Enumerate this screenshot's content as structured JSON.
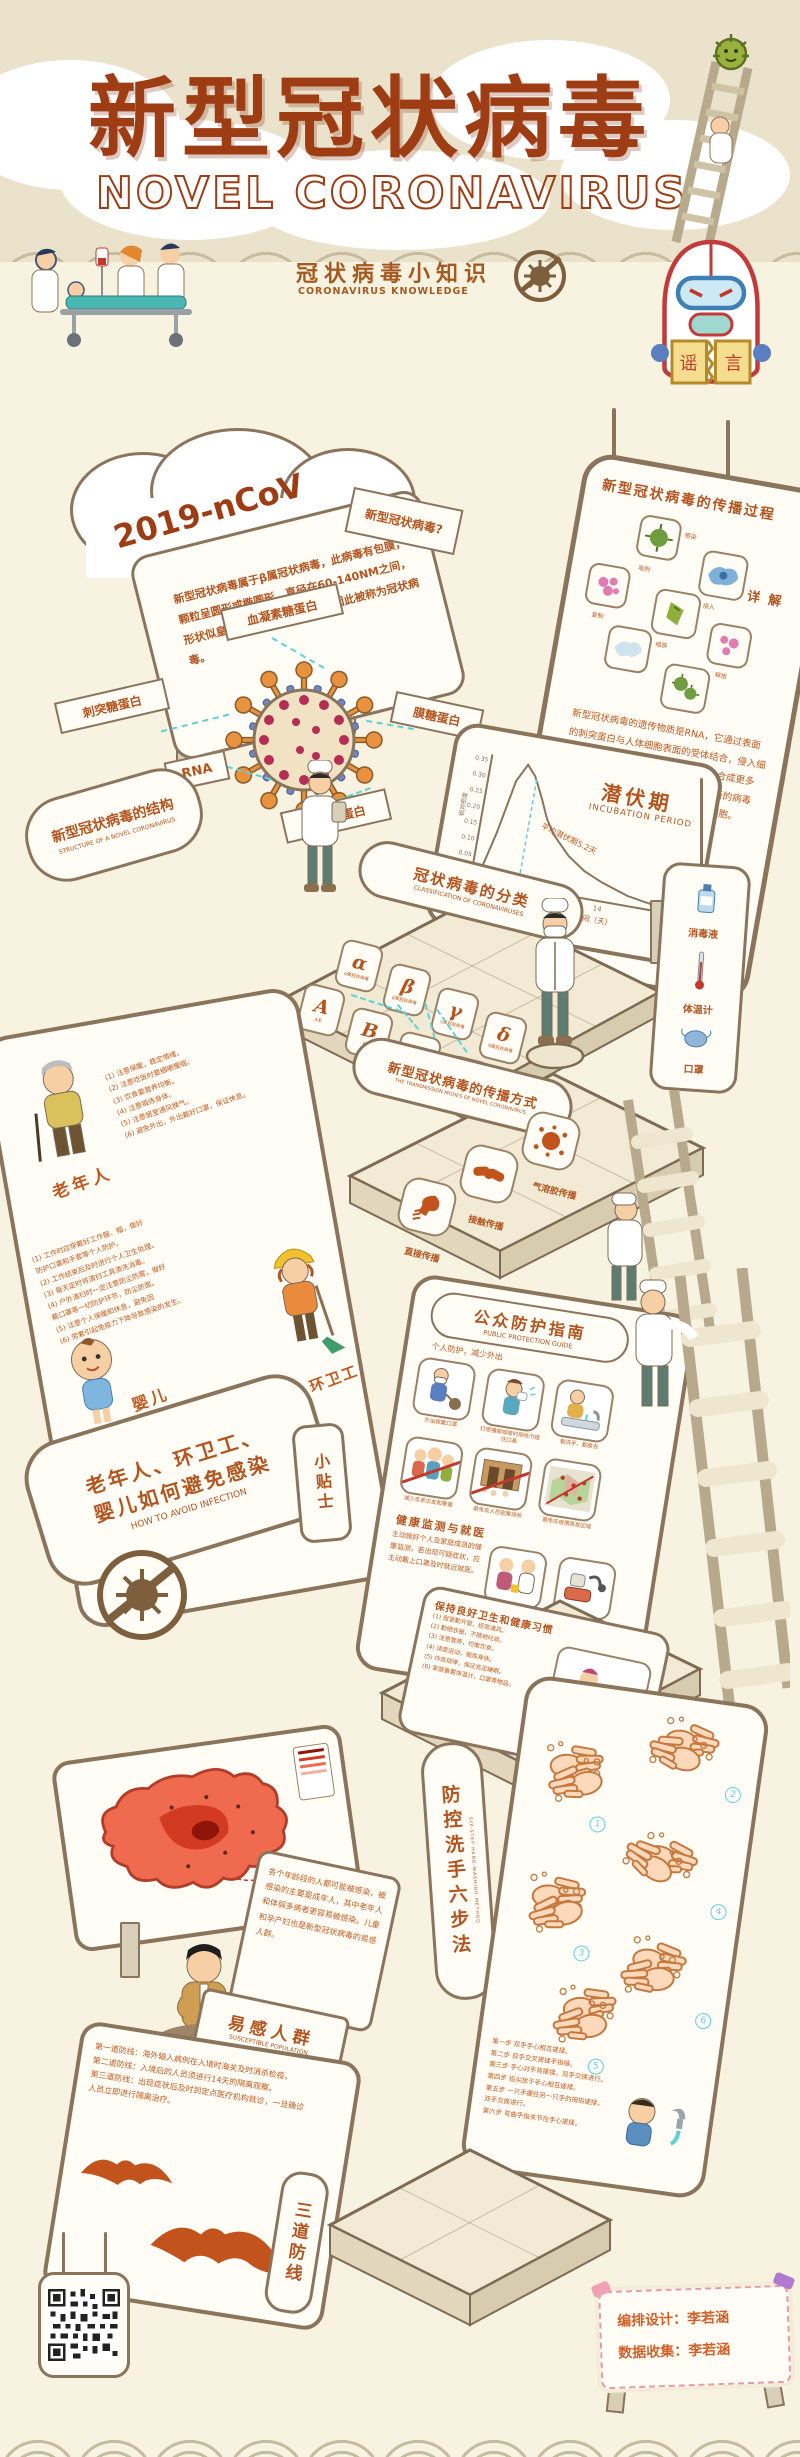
{
  "header": {
    "title": "新型冠状病毒",
    "subtitle": "NOVEL CORONAVIRUS",
    "tagline_zh": "冠状病毒小知识",
    "tagline_en": "CORONAVIRUS KNOWLEDGE",
    "rumor_left": "谣",
    "rumor_right": "言"
  },
  "intro": {
    "cloud_label": "2019-nCoV",
    "board_text": "新型冠状病毒属于β属冠状病毒，此病毒有包膜，颗粒呈圆形或椭圆形，直径在60-140NM之间，形状似皇冠，因表面凸凹不平，因此被称为冠状病毒。",
    "question_sign": "新型冠状病毒?"
  },
  "structure": {
    "sign_zh": "新型冠状病毒的结构",
    "sign_en": "STRUCTURE OF A NOVEL CORONAVIRUS",
    "label_hemagglutinin": "血凝素糖蛋白",
    "label_spike": "刺突糖蛋白",
    "label_rna": "RNA",
    "label_nucleocapsid": "核衣壳蛋白",
    "label_membrane": "膜糖蛋白"
  },
  "spread": {
    "title": "新型冠状病毒的传播过程",
    "detail_title": "详 解",
    "detail_text": "新型冠状病毒的遗传物质是RNA，它通过表面的刺突蛋白与人体细胞表面的受体结合，侵入细胞后释放RNA并进行复制，利用细胞合成更多的病毒蛋白质和RNA片段，再组装成新的病毒颗粒释放出来，继续感染更多的健康细胞。",
    "steps": [
      "感染",
      "吸附",
      "侵入",
      "复制",
      "组装",
      "释放"
    ]
  },
  "incubation": {
    "title_zh": "潜伏期",
    "title_en": "INCUBATION PERIOD",
    "annotation": "平均潜伏期5.2天",
    "xlabel": "从感染到发病的时间（天）",
    "ylabel": "相对密度"
  },
  "chart_data": {
    "type": "area",
    "title": "潜伏期 INCUBATION PERIOD",
    "xlabel": "从感染到发病的时间（天）",
    "ylabel": "相对密度",
    "x": [
      0,
      1,
      2,
      3,
      4,
      5,
      6,
      7,
      8,
      10,
      12,
      14,
      17,
      21
    ],
    "y": [
      0,
      0.04,
      0.15,
      0.28,
      0.34,
      0.31,
      0.25,
      0.19,
      0.15,
      0.09,
      0.055,
      0.035,
      0.015,
      0.005
    ],
    "xticks": [
      7,
      14,
      21
    ],
    "yticks": [
      "0.35",
      "0.30",
      "0.25",
      "0.20",
      "0.15",
      "0.10",
      "0.05",
      "0.00"
    ],
    "xlim": [
      0,
      22
    ],
    "ylim": [
      0,
      0.35
    ],
    "annotation": "平均潜伏期5.2天",
    "annotation_x": 5.2,
    "grid": false,
    "legend": false
  },
  "classification": {
    "sign_zh": "冠状病毒的分类",
    "sign_en": "CLASSIFICATION OF CORONAVIRUSES",
    "tiles": [
      {
        "letter": "α",
        "caption": "α属冠状病毒"
      },
      {
        "letter": "β",
        "caption": "β属冠状病毒"
      },
      {
        "letter": "γ",
        "caption": "γ属冠状病毒"
      },
      {
        "letter": "δ",
        "caption": "δ属冠状病毒"
      },
      {
        "letter": "A",
        "caption": "A系"
      },
      {
        "letter": "B",
        "caption": "B系"
      },
      {
        "letter": "C",
        "caption": "C系"
      },
      {
        "letter": "D",
        "caption": "D系"
      }
    ]
  },
  "transmission": {
    "sign_zh": "新型冠状病毒的传播方式",
    "sign_en": "THE TRANSMISSION MODES OF NOVEL CORONAVIRUS",
    "modes": [
      "直接传播",
      "接触传播",
      "气溶胶传播"
    ]
  },
  "supplies": {
    "items": [
      "消毒液",
      "体温计",
      "口罩"
    ]
  },
  "avoid": {
    "sign_zh1": "老年人、环卫工、",
    "sign_zh2": "婴儿如何避免感染",
    "sign_en": "HOW TO AVOID INFECTION",
    "tips_badge": "小贴士",
    "elderly_name": "老年人",
    "sanitation_name": "环卫工",
    "baby_name": "婴儿",
    "elderly_tips": [
      "(1) 注意保暖，稳定情绪。",
      "(2) 注意吃饭时要细嚼慢咽。",
      "(3) 饮食要营养均衡。",
      "(4) 注意锻炼身体。",
      "(5) 注意居室通风换气。",
      "(6) 避免外出，外出戴好口罩，保证休息。"
    ],
    "sanitation_tips": [
      "(1) 工作时应穿戴好工作服、帽，做好",
      "     防护口罩和手套等个人防护。",
      "(2) 工作结束后及时进行个人卫生处理。",
      "(3) 每天定时将清扫工具清洗消毒。",
      "(4) 户外清扫时一定注意防尘防雾，做好",
      "     戴口罩等一切防护环节，防尘防面。",
      "(5) 注意个人保暖和休息，避免因",
      "(6) 劳累引起免疫力下降导致感染的发生。"
    ],
    "baby_tips": [
      "(1) 尽量不要在流感季节外出。",
      "(2) 一定要注意保暖，避免着凉。",
      "(3) 一定要勤洗手、勤换衣。",
      "(4) 一定要对婴儿用品进行消毒杀菌。",
      "(5) 外出一定要戴好口罩，以防感染。",
      "(6) 一定要多吃熟食，少喝冷的饮料。"
    ]
  },
  "public_guide": {
    "title_zh": "公众防护指南",
    "title_en": "PUBLIC PROTECTION GUIDE",
    "subtitle": "个人防护，减少外出",
    "items": [
      "外出佩戴口罩",
      "打喷嚏或咳嗽时用纸巾捂住口鼻",
      "勤洗手，勤换衣",
      "减少走亲访友和聚餐",
      "避免去人员密集场所",
      "避免去疫情高发区域",
      "出现症状及时就医",
      "常备体温计、口罩等用品"
    ],
    "section2_title": "健康监测与就医",
    "section2_text": "主动做好个人及家庭成员的健康监测，若出现可疑症状，应主动戴上口罩及时就近就医。"
  },
  "hygiene": {
    "title": "保持良好卫生和健康习惯",
    "items": [
      "(1) 居室勤开窗，经常通风。",
      "(2) 勤晒衣被，不随地吐痰。",
      "(3) 注意营养，均衡饮食。",
      "(4) 适度运动，锻炼身体。",
      "(5) 作息规律，保证充足睡眠。",
      "(6) 家庭备置体温计、口罩等物品。"
    ]
  },
  "handwash": {
    "sign_zh": "防控洗手六步法",
    "sign_en": "SIX-STEP HAND-WASHING METHOD",
    "numbers": [
      "1",
      "2",
      "3",
      "4",
      "5",
      "6"
    ],
    "steps": [
      "第一步 双手手心相互搓揉。",
      "第二步 双手交叉搓揉手指缝。",
      "第三步 手心对手背搓揉，双手交换进行。",
      "第四步 指尖放于手心相互搓揉。",
      "第五步 一只手握住另一只手的拇指搓揉，双手交换进行。",
      "第六步 弯曲手指关节在手心搓揉。"
    ]
  },
  "susceptible": {
    "sign_zh": "易感人群",
    "sign_en": "SUSCEPTIBLE POPULATION",
    "text": "各个年龄段的人都可能被感染，被感染的主要是成年人，其中老年人和体弱多病者更容易被感染。儿童和孕产妇也是新型冠状病毒的易感人群。"
  },
  "defense": {
    "sign": "三道防线",
    "lines": [
      "第一道防线：海外输入病例在入境时海关及时消杀检疫。",
      "第二道防线：入境后的人员须进行14天的隔离观察。",
      "第三道防线：出现症状后及时到定点医疗机构就诊，一旦确诊人员立即进行隔离治疗。"
    ]
  },
  "credits": {
    "line1": "编排设计：李若涵",
    "line2": "数据收集：李若涵"
  },
  "colors": {
    "accent": "#b4541f",
    "title": "#9e3c13",
    "teal": "#5fd0d5",
    "orange_icon": "#c2531d",
    "panel_border": "#8a745c",
    "bg": "#f8f2e1",
    "band": "#ebe2cb"
  }
}
